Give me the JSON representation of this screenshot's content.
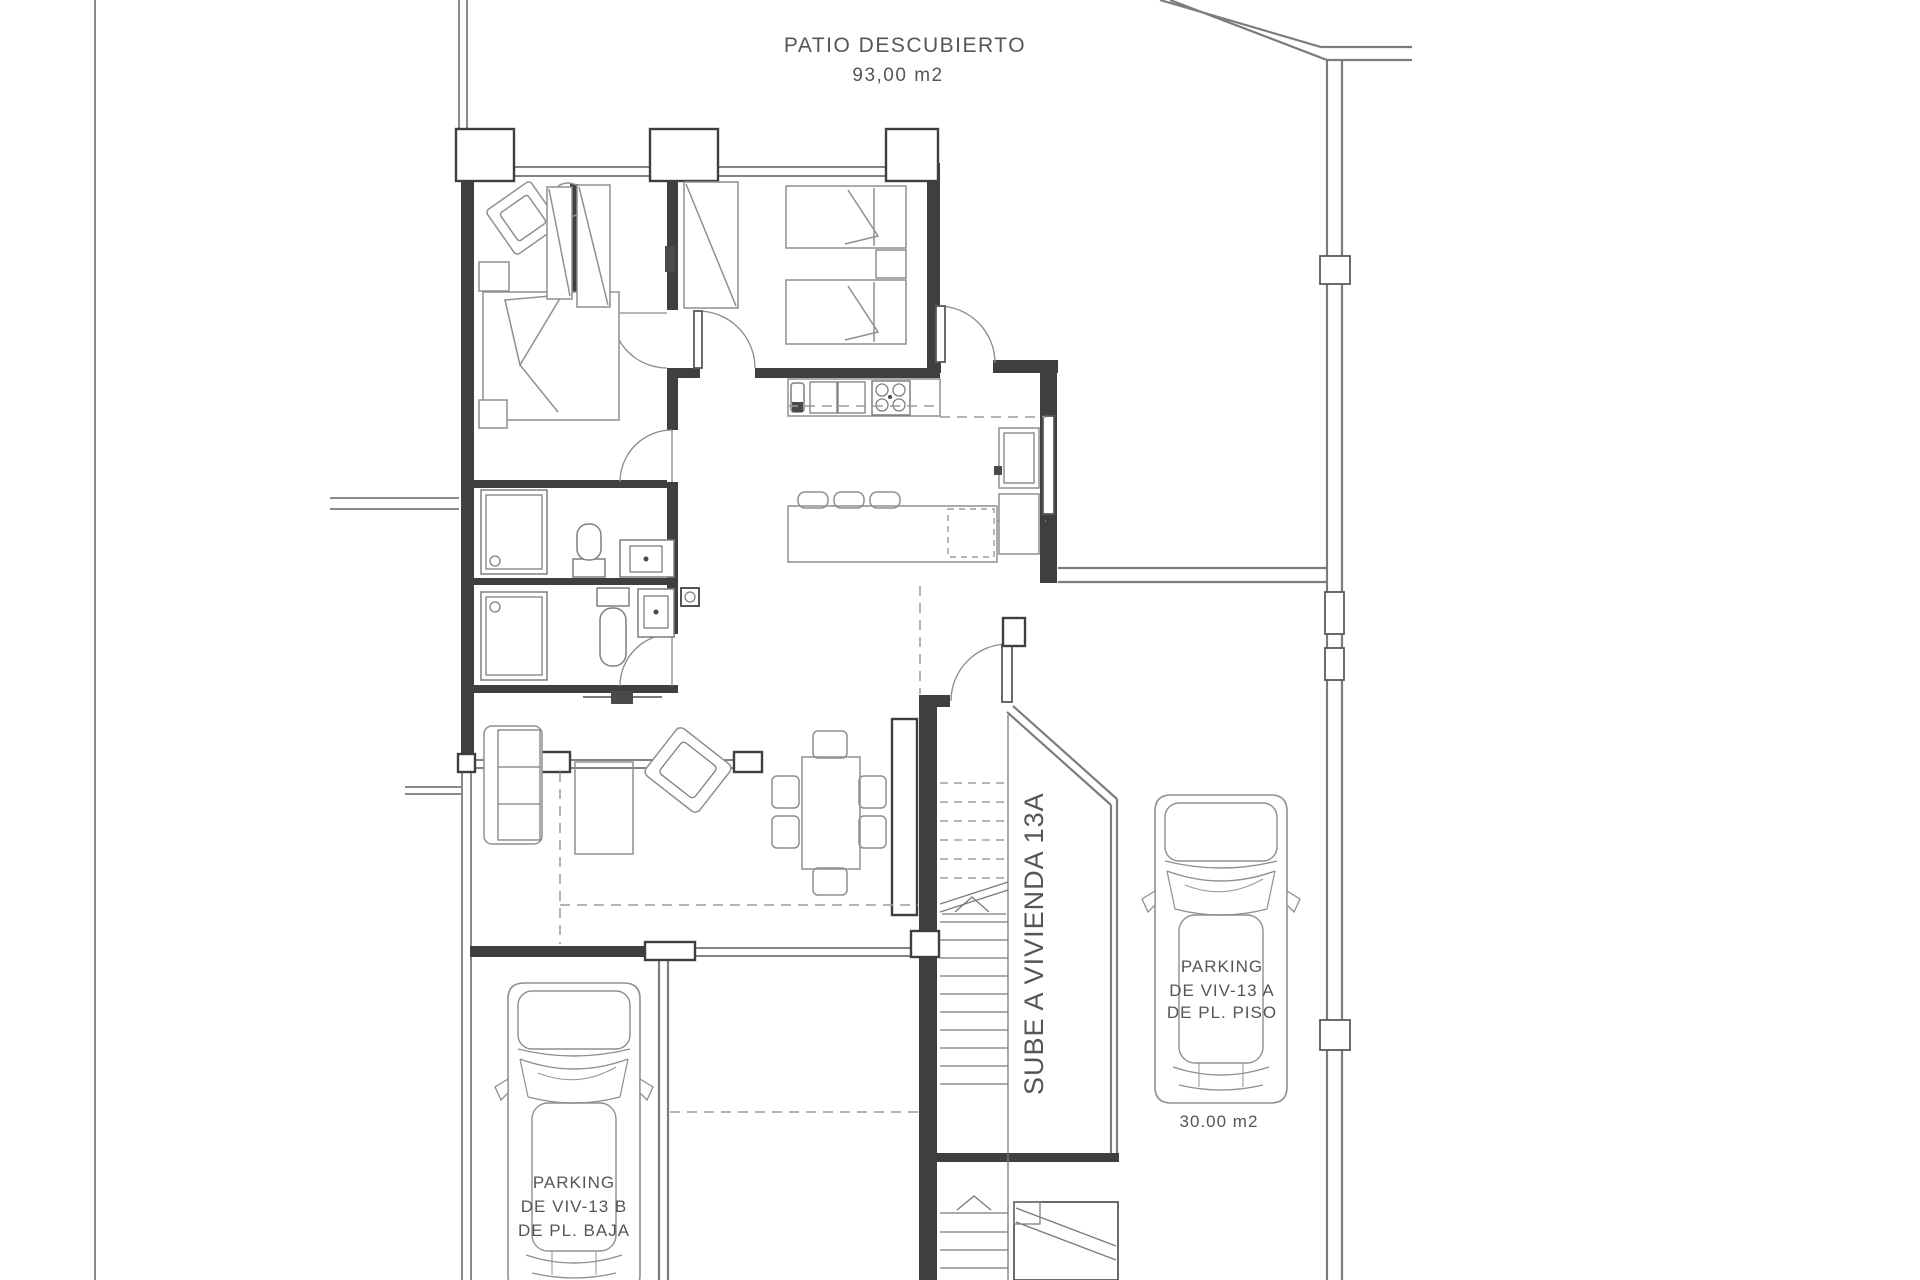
{
  "labels": {
    "patio_title": "PATIO DESCUBIERTO",
    "patio_area": "93,00 m2",
    "stairs_note": "SUBE A VIVIENDA 13A",
    "parking_a": {
      "line1": "PARKING",
      "line2": "DE VIV-13 A",
      "line3": "DE PL. PISO",
      "area": "30.00 m2"
    },
    "parking_b": {
      "line1": "PARKING",
      "line2": "DE VIV-13 B",
      "line3": "DE PL. BAJA"
    }
  },
  "colors": {
    "walls": "#3f3f3f",
    "site_lines": "#8a8a8a",
    "furniture": "#8f8f8f",
    "text": "#555555",
    "background": "#ffffff"
  }
}
